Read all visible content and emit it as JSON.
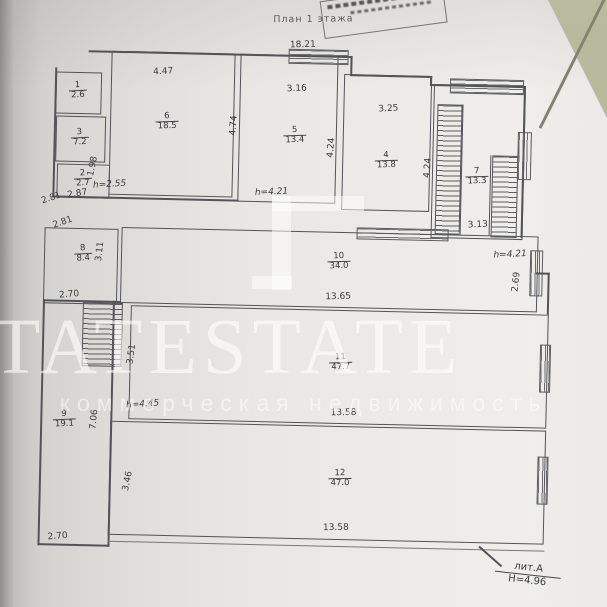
{
  "header": {
    "title": "План 1 этажа"
  },
  "watermark": {
    "brand": "TATESTATE",
    "tagline": "коммерческая недвижимость"
  },
  "footer": {
    "litera": "лит.А",
    "height_note": "Н=4.96"
  },
  "rooms": {
    "r1": {
      "id": "1",
      "area": "2.6"
    },
    "r3": {
      "id": "3",
      "area": "7.2"
    },
    "r2": {
      "id": "2",
      "area": "2.7"
    },
    "r6": {
      "id": "6",
      "area": "18.5"
    },
    "r5": {
      "id": "5",
      "area": "13.4"
    },
    "r4": {
      "id": "4",
      "area": "13.8"
    },
    "r7": {
      "id": "7",
      "area": "13.3"
    },
    "r8": {
      "id": "8",
      "area": "8.4"
    },
    "r10": {
      "id": "10",
      "area": "34.0"
    },
    "r11": {
      "id": "11",
      "area": "47.7"
    },
    "r9": {
      "id": "9",
      "area": "19.1"
    },
    "r12": {
      "id": "12",
      "area": "47.0"
    }
  },
  "dims": {
    "top_overall": "18.21",
    "r6_width": "4.47",
    "r5_width": "3.16",
    "r4_width": "3.25",
    "r6_height": "4.74",
    "r5_height": "4.24",
    "r4_height": "4.24",
    "stair_width": "3.13",
    "small_width": "2.87",
    "small_height": "1.98",
    "left_upper": "2.81",
    "left_lower": "2.81",
    "r8_height": "3.11",
    "r8_width": "2.70",
    "band2_width": "13.65",
    "band2_right": "2.69",
    "stair2_height": "3.51",
    "left_wall": "7.06",
    "band3_width": "13.58",
    "r12_side": "3.46",
    "bottom_left": "2.70",
    "band4_width": "13.58"
  },
  "heights": {
    "small_rooms": "h=2.55",
    "hall_top": "h=4.21",
    "hall_right": "h=4.21",
    "hall_low": "h=4.45"
  }
}
